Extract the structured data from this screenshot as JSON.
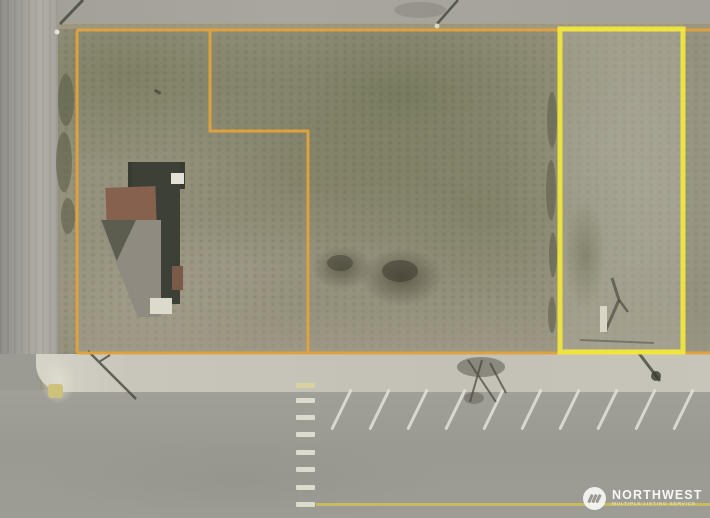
{
  "watermark": {
    "brand": "NORTHWEST",
    "tagline": "MULTIPLE LISTING SERVICE",
    "logo_icon": "nwmls-triple-slash-icon"
  },
  "map_overlays": {
    "primary_parcel_outline_color": "#E1A23D",
    "highlight_parcel_outline_color": "#F2E93C",
    "road_centerline_color": "#C9BD5E"
  }
}
